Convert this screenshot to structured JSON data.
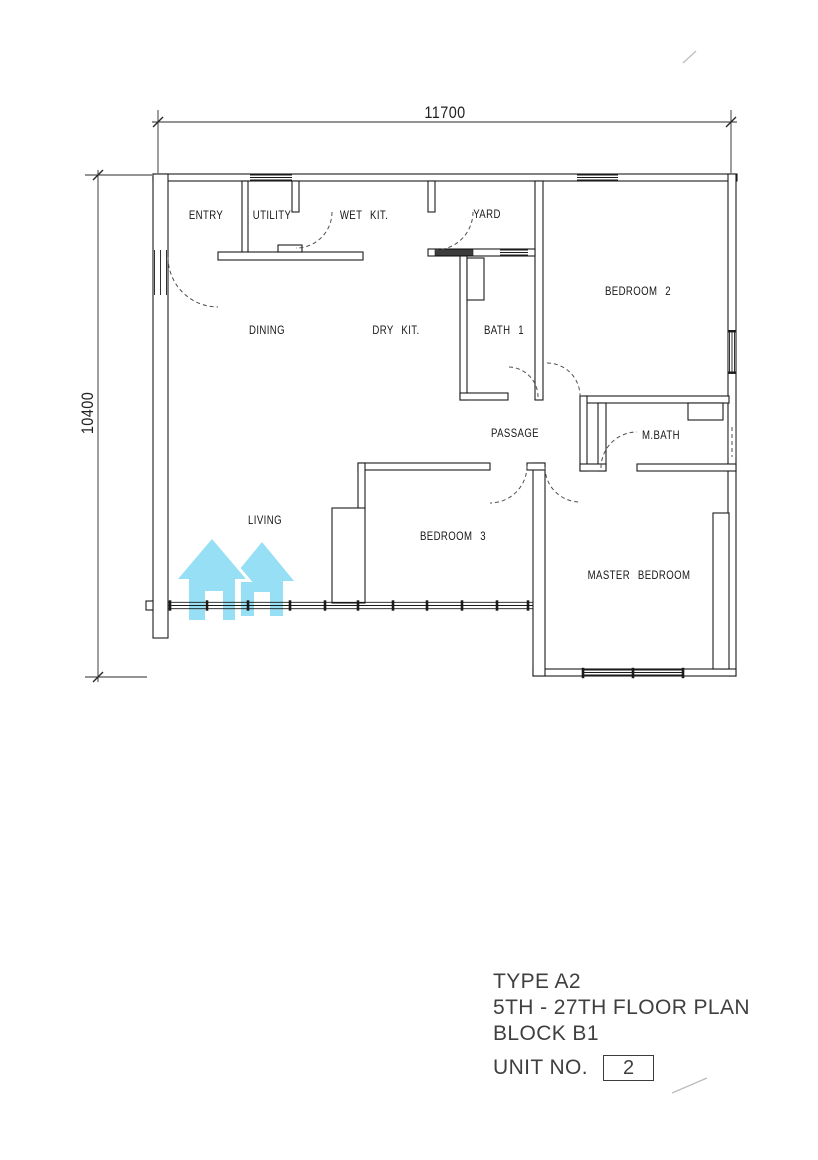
{
  "dimensions": {
    "width": "11700",
    "height": "10400"
  },
  "rooms": {
    "entry": "ENTRY",
    "utility": "UTILITY",
    "wet_kitchen": "WET KIT.",
    "yard": "YARD",
    "bedroom2": "BEDROOM 2",
    "dining": "DINING",
    "dry_kitchen": "DRY KIT.",
    "bath1": "BATH 1",
    "passage": "PASSAGE",
    "master_bath": "M.BATH",
    "living": "LIVING",
    "bedroom3": "BEDROOM 3",
    "master_bedroom": "MASTER BEDROOM"
  },
  "watermark": {
    "icon": "twin-house-logo",
    "color": "#97dff4"
  },
  "title_block": {
    "type_label": "TYPE A2",
    "floor_label": "5TH - 27TH FLOOR PLAN",
    "block_label": "BLOCK B1",
    "unit_label": "UNIT NO.",
    "unit_number": "2"
  }
}
